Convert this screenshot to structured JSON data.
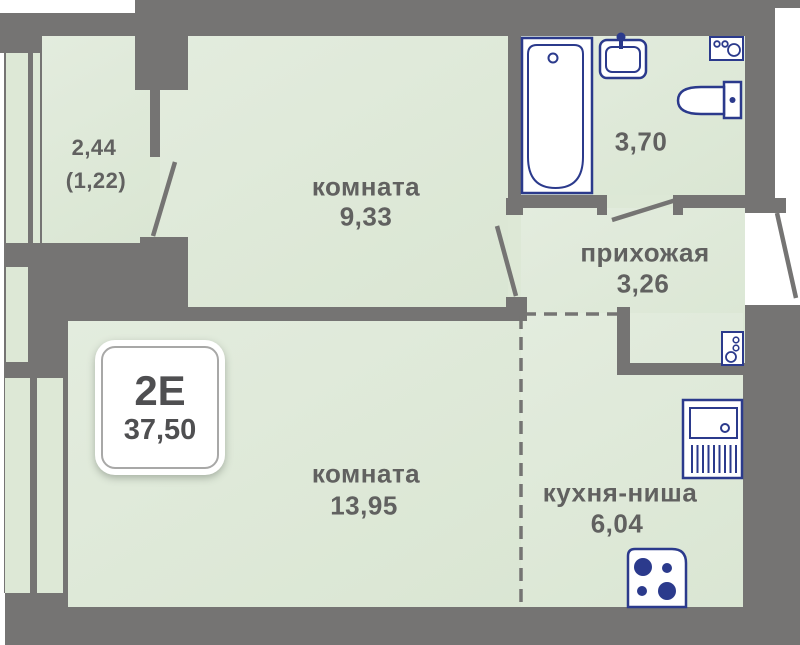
{
  "plan": {
    "title": "apartment floor plan",
    "badge": {
      "type": "2Е",
      "total_area": "37,50"
    },
    "rooms": [
      {
        "id": "balcony",
        "name": "",
        "area": "2,44",
        "area_reduced": "(1,22)"
      },
      {
        "id": "room-1",
        "name": "комната",
        "area": "9,33"
      },
      {
        "id": "bathroom",
        "name": "",
        "area": "3,70"
      },
      {
        "id": "hallway",
        "name": "прихожая",
        "area": "3,26"
      },
      {
        "id": "room-2",
        "name": "комната",
        "area": "13,95"
      },
      {
        "id": "kitchen",
        "name": "кухня-ниша",
        "area": "6,04"
      }
    ],
    "fixtures": [
      "bathtub",
      "bath-sink",
      "washing-machine",
      "toilet",
      "kitchen-sink",
      "stove",
      "water-heater"
    ],
    "colors": {
      "wall": "#757473",
      "floor": "#dde8d6",
      "fixture_stroke": "#2b3a8c",
      "label_text": "#616160",
      "badge_text": "#4f4f51",
      "outside": "#ffffff"
    }
  }
}
